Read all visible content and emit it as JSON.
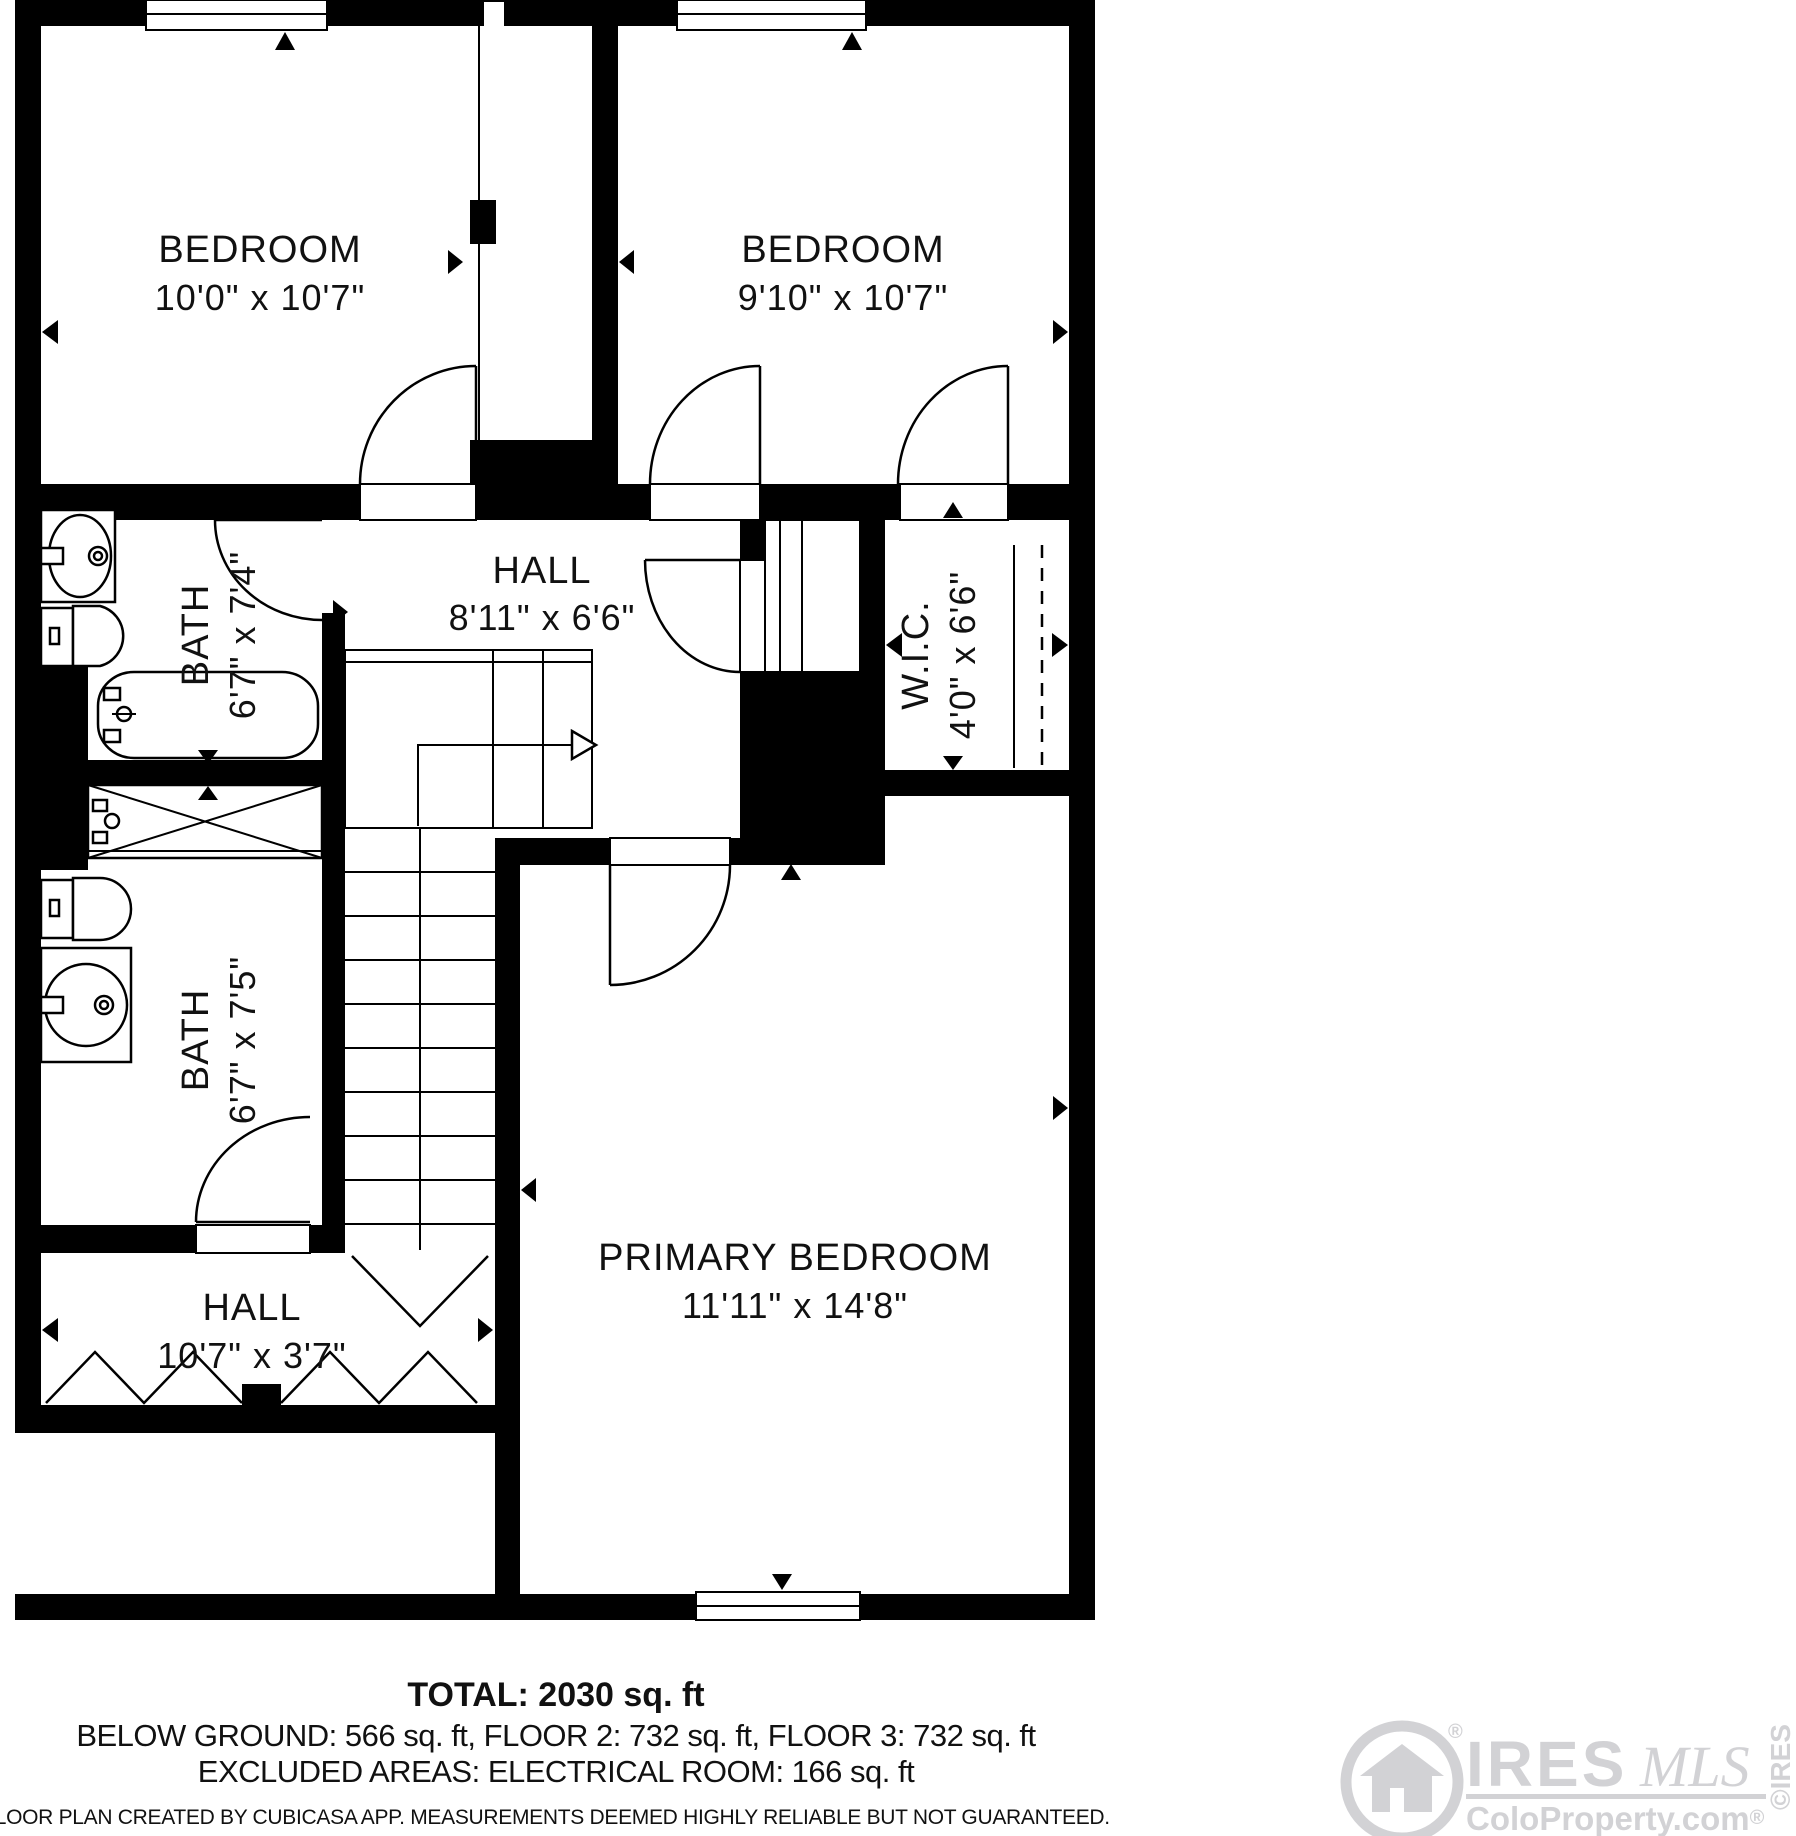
{
  "plan": {
    "rooms": [
      {
        "id": "bedroom-left",
        "label": "BEDROOM",
        "dims": "10'0\" x 10'7\""
      },
      {
        "id": "bedroom-right",
        "label": "BEDROOM",
        "dims": "9'10\" x 10'7\""
      },
      {
        "id": "hall-upper",
        "label": "HALL",
        "dims": "8'11\" x 6'6\""
      },
      {
        "id": "wic",
        "label": "W.I.C.",
        "dims": "4'0\" x 6'6\""
      },
      {
        "id": "bath-upper",
        "label": "BATH",
        "dims": "6'7\" x 7'4\""
      },
      {
        "id": "bath-lower",
        "label": "BATH",
        "dims": "6'7\" x 7'5\""
      },
      {
        "id": "primary-bedroom",
        "label": "PRIMARY BEDROOM",
        "dims": "11'11\" x 14'8\""
      },
      {
        "id": "hall-lower",
        "label": "HALL",
        "dims": "10'7\" x 3'7\""
      }
    ]
  },
  "summary": {
    "total": "TOTAL: 2030 sq. ft",
    "breakdown": "BELOW GROUND: 566 sq. ft, FLOOR 2: 732 sq. ft, FLOOR 3: 732 sq. ft",
    "excluded": "EXCLUDED AREAS: ELECTRICAL ROOM: 166 sq. ft"
  },
  "disclaimer": "FLOOR PLAN CREATED BY CUBICASA APP. MEASUREMENTS DEEMED HIGHLY RELIABLE BUT NOT GUARANTEED.",
  "watermark": {
    "brand": "IRES",
    "script": "MLS",
    "site": "ColoProperty.com",
    "reg": "®",
    "side": "©IRES"
  },
  "colors": {
    "wall": "#000000",
    "watermark": "#d2d2d5"
  }
}
